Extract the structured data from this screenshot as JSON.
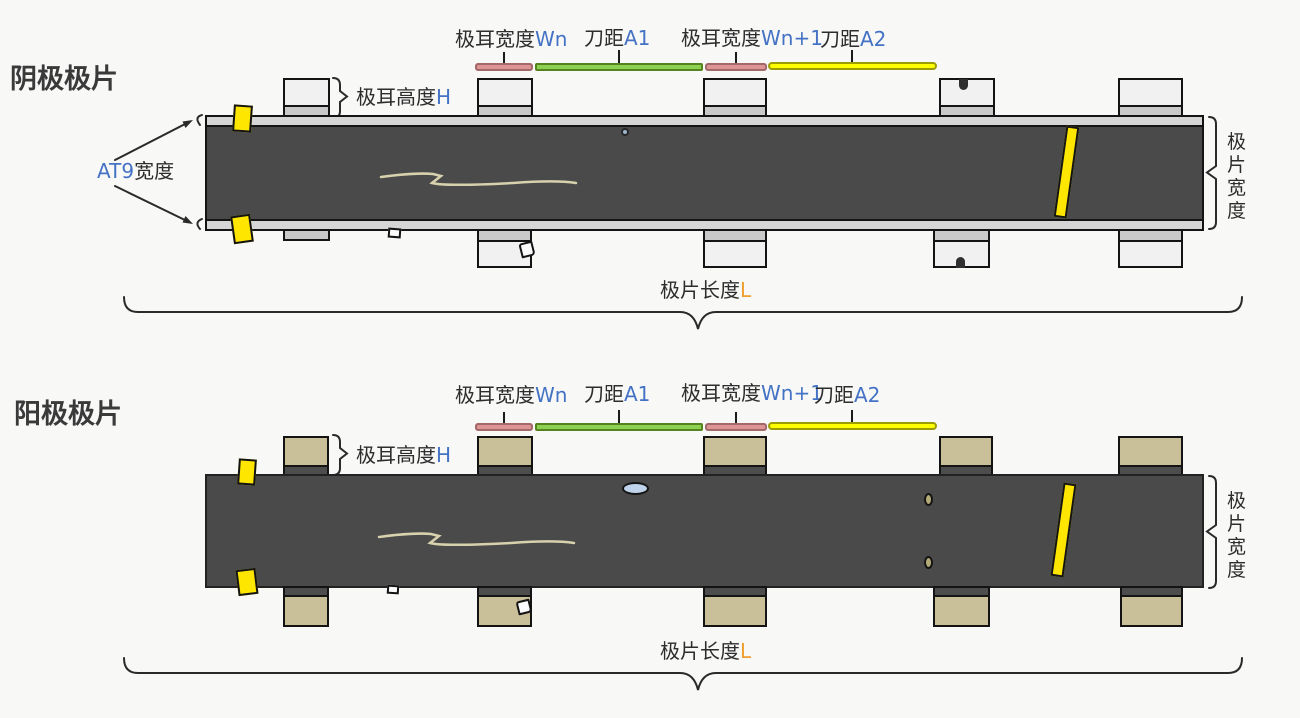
{
  "titles": {
    "cathode": "阴极极片",
    "anode": "阳极极片"
  },
  "dimension_labels": {
    "tab_width_prefix": "极耳宽度",
    "wn": "Wn",
    "wn_plus_1": "Wn+1",
    "knife_prefix": "刀距",
    "a1": "A1",
    "a2": "A2",
    "tab_height_prefix": "极耳高度",
    "h": "H",
    "at9_prefix": "AT9",
    "at9_suffix": "宽度",
    "sheet_width": "极片宽度",
    "sheet_length_prefix": "极片长度",
    "l": "L"
  },
  "colors": {
    "background": "#f8f8f7",
    "sheet_fill": "#4a4a4a",
    "foil_edge_strip": "#d6d6d6",
    "cathode_tab_fill": "#f1f1f1",
    "cathode_tab_band": "#c9c9c9",
    "anode_tab_fill": "#c9c09a",
    "anode_tab_band": "#4d4d4d",
    "tab_width_bar": "#dc9494",
    "knife_a1_bar": "#8ed050",
    "knife_a2_bar": "#ffff00",
    "tape_mark": "#ffe600",
    "accent_blue": "#4472c4",
    "accent_orange": "#ee9f2e",
    "outline": "#141414"
  }
}
